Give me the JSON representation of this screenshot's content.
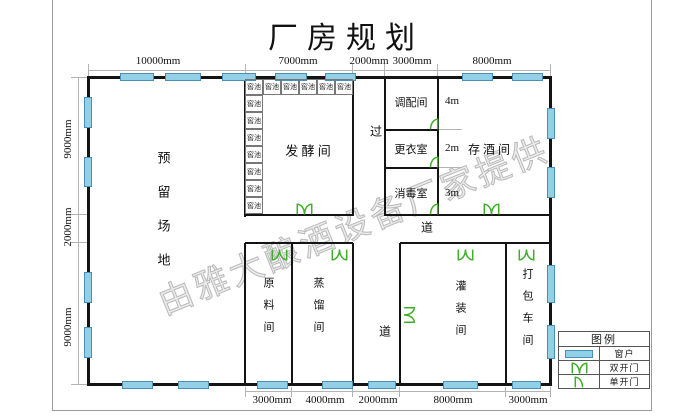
{
  "title": "厂房规划",
  "watermark": {
    "text": "由雅大酿酒设备厂家提供"
  },
  "colors": {
    "wall": "#141414",
    "window_fill": "#92d0e8",
    "window_border": "#4a8fb5",
    "door": "#3fae29",
    "dim_line": "#b3b3b3",
    "page_border": "#9a9a9a"
  },
  "legend": {
    "title": "图例",
    "items": [
      {
        "symbol": "window",
        "label": "窗户"
      },
      {
        "symbol": "double-door",
        "label": "双开门"
      },
      {
        "symbol": "single-door",
        "label": "单开门"
      }
    ]
  },
  "plan": {
    "page_border": [
      [
        52,
        0,
        1,
        410
      ],
      [
        651,
        0,
        1,
        410
      ],
      [
        52,
        410,
        600,
        1
      ]
    ],
    "walls": [
      [
        88,
        76,
        463,
        3
      ],
      [
        88,
        383,
        463,
        3
      ],
      [
        87,
        76,
        3,
        310
      ],
      [
        549,
        76,
        3,
        310
      ],
      [
        244,
        77,
        2,
        140
      ],
      [
        244,
        243,
        2,
        141
      ],
      [
        352,
        77,
        2,
        139
      ],
      [
        384,
        77,
        2,
        139
      ],
      [
        437,
        77,
        2,
        139
      ],
      [
        385,
        129,
        53,
        2
      ],
      [
        385,
        167,
        53,
        2
      ],
      [
        245,
        214,
        108,
        2
      ],
      [
        385,
        214,
        53,
        2
      ],
      [
        438,
        214,
        112,
        2
      ],
      [
        245,
        242,
        108,
        2
      ],
      [
        400,
        242,
        151,
        2
      ],
      [
        352,
        243,
        2,
        141
      ],
      [
        399,
        243,
        2,
        141
      ],
      [
        291,
        243,
        2,
        141
      ],
      [
        505,
        243,
        2,
        141
      ]
    ],
    "dim_lines": [
      [
        88,
        70,
        463,
        1
      ],
      [
        78,
        77,
        1,
        308
      ],
      [
        245,
        391,
        306,
        1
      ],
      [
        438,
        129,
        24,
        1
      ],
      [
        438,
        167,
        24,
        1
      ],
      [
        88,
        64,
        1,
        12
      ],
      [
        245,
        64,
        1,
        12
      ],
      [
        352,
        64,
        1,
        12
      ],
      [
        384,
        64,
        1,
        12
      ],
      [
        437,
        64,
        1,
        12
      ],
      [
        550,
        64,
        1,
        12
      ],
      [
        71,
        77,
        17,
        1
      ],
      [
        71,
        214,
        17,
        1
      ],
      [
        71,
        242,
        17,
        1
      ],
      [
        71,
        384,
        17,
        1
      ],
      [
        245,
        387,
        1,
        10
      ],
      [
        291,
        387,
        1,
        10
      ],
      [
        352,
        387,
        1,
        10
      ],
      [
        399,
        387,
        1,
        10
      ],
      [
        505,
        387,
        1,
        10
      ],
      [
        550,
        387,
        1,
        10
      ]
    ],
    "windows": [
      [
        120,
        73,
        34,
        8
      ],
      [
        165,
        73,
        36,
        8
      ],
      [
        222,
        73,
        34,
        8
      ],
      [
        275,
        73,
        32,
        8
      ],
      [
        325,
        73,
        31,
        8
      ],
      [
        462,
        73,
        31,
        8
      ],
      [
        512,
        73,
        31,
        8
      ],
      [
        84,
        97,
        8,
        31
      ],
      [
        84,
        157,
        8,
        30
      ],
      [
        84,
        272,
        8,
        31
      ],
      [
        84,
        327,
        8,
        31
      ],
      [
        547,
        108,
        8,
        31
      ],
      [
        547,
        167,
        8,
        31
      ],
      [
        547,
        265,
        8,
        38
      ],
      [
        547,
        325,
        8,
        34
      ],
      [
        122,
        381,
        31,
        8
      ],
      [
        178,
        381,
        31,
        8
      ],
      [
        257,
        381,
        31,
        8
      ],
      [
        322,
        381,
        31,
        8
      ],
      [
        368,
        381,
        28,
        8
      ],
      [
        443,
        381,
        35,
        8
      ],
      [
        512,
        381,
        29,
        8
      ]
    ],
    "pits": {
      "label": "窖池",
      "cells": [
        [
          245,
          79,
          18,
          16
        ],
        [
          263,
          79,
          18,
          16
        ],
        [
          281,
          79,
          18,
          16
        ],
        [
          299,
          79,
          18,
          16
        ],
        [
          317,
          79,
          18,
          16
        ],
        [
          335,
          79,
          18,
          16
        ],
        [
          245,
          95,
          18,
          17
        ],
        [
          245,
          112,
          18,
          17
        ],
        [
          245,
          129,
          18,
          17
        ],
        [
          245,
          146,
          18,
          17
        ],
        [
          245,
          163,
          18,
          17
        ],
        [
          245,
          180,
          18,
          17
        ],
        [
          245,
          197,
          18,
          17
        ]
      ]
    },
    "doors": [
      {
        "type": "double",
        "x": 296,
        "y": 202,
        "dir": "up"
      },
      {
        "type": "double",
        "x": 483,
        "y": 202,
        "dir": "up"
      },
      {
        "type": "double",
        "x": 271,
        "y": 244,
        "dir": "down"
      },
      {
        "type": "double",
        "x": 331,
        "y": 244,
        "dir": "down"
      },
      {
        "type": "double",
        "x": 457,
        "y": 244,
        "dir": "down"
      },
      {
        "type": "double",
        "x": 518,
        "y": 244,
        "dir": "down"
      },
      {
        "type": "double",
        "x": 399,
        "y": 306,
        "dir": "right"
      },
      {
        "type": "single",
        "x": 429,
        "y": 117,
        "dir": "wall-right"
      },
      {
        "type": "single",
        "x": 429,
        "y": 155,
        "dir": "wall-right"
      },
      {
        "type": "single",
        "x": 429,
        "y": 202,
        "dir": "wall-right"
      }
    ],
    "labels": [
      {
        "id": "room-reserved-area",
        "text": "预留场地",
        "cx": 163,
        "cy": 219,
        "fs": 13,
        "vertical": true,
        "gap": 21
      },
      {
        "id": "room-fermentation",
        "text": "发 酵 间",
        "cx": 308,
        "cy": 150,
        "fs": 13
      },
      {
        "id": "room-blending",
        "text": "调配间",
        "cx": 411,
        "cy": 102,
        "fs": 11
      },
      {
        "id": "room-changing",
        "text": "更衣室",
        "cx": 411,
        "cy": 149,
        "fs": 11
      },
      {
        "id": "room-disinfection",
        "text": "消毒室",
        "cx": 411,
        "cy": 193,
        "fs": 11
      },
      {
        "id": "room-wine-storage",
        "text": "存 酒 间",
        "cx": 489,
        "cy": 149,
        "fs": 12
      },
      {
        "id": "room-raw-material",
        "text": "原料间",
        "cx": 268,
        "cy": 310,
        "fs": 11,
        "vertical": true,
        "gap": 11
      },
      {
        "id": "room-distillation",
        "text": "蒸馏间",
        "cx": 318,
        "cy": 310,
        "fs": 11,
        "vertical": true,
        "gap": 11
      },
      {
        "id": "room-filling",
        "text": "灌装间",
        "cx": 460,
        "cy": 313,
        "fs": 11,
        "vertical": true,
        "gap": 11
      },
      {
        "id": "room-packing",
        "text": "打包车间",
        "cx": 527,
        "cy": 312,
        "fs": 11,
        "vertical": true,
        "gap": 11
      },
      {
        "id": "corridor-pass",
        "text": "过",
        "cx": 376,
        "cy": 131,
        "fs": 12
      },
      {
        "id": "corridor-way-mid",
        "text": "道",
        "cx": 427,
        "cy": 227,
        "fs": 12
      },
      {
        "id": "corridor-way-bottom",
        "text": "道",
        "cx": 385,
        "cy": 331,
        "fs": 12
      }
    ],
    "dims": [
      {
        "text": "10000mm",
        "cx": 158,
        "cy": 61
      },
      {
        "text": "7000mm",
        "cx": 298,
        "cy": 61
      },
      {
        "text": "2000mm",
        "cx": 369,
        "cy": 61
      },
      {
        "text": "3000mm",
        "cx": 412,
        "cy": 61
      },
      {
        "text": "8000mm",
        "cx": 492,
        "cy": 61
      },
      {
        "text": "9000mm",
        "cx": 68,
        "cy": 139,
        "vertical": true
      },
      {
        "text": "2000mm",
        "cx": 68,
        "cy": 227,
        "vertical": true
      },
      {
        "text": "9000mm",
        "cx": 68,
        "cy": 327,
        "vertical": true
      },
      {
        "text": "3000mm",
        "cx": 272,
        "cy": 400
      },
      {
        "text": "4000mm",
        "cx": 325,
        "cy": 400
      },
      {
        "text": "2000mm",
        "cx": 378,
        "cy": 400
      },
      {
        "text": "8000mm",
        "cx": 453,
        "cy": 400
      },
      {
        "text": "3000mm",
        "cx": 528,
        "cy": 400
      },
      {
        "text": "4m",
        "cx": 452,
        "cy": 101
      },
      {
        "text": "2m",
        "cx": 452,
        "cy": 148
      },
      {
        "text": "3m",
        "cx": 452,
        "cy": 193
      }
    ]
  }
}
